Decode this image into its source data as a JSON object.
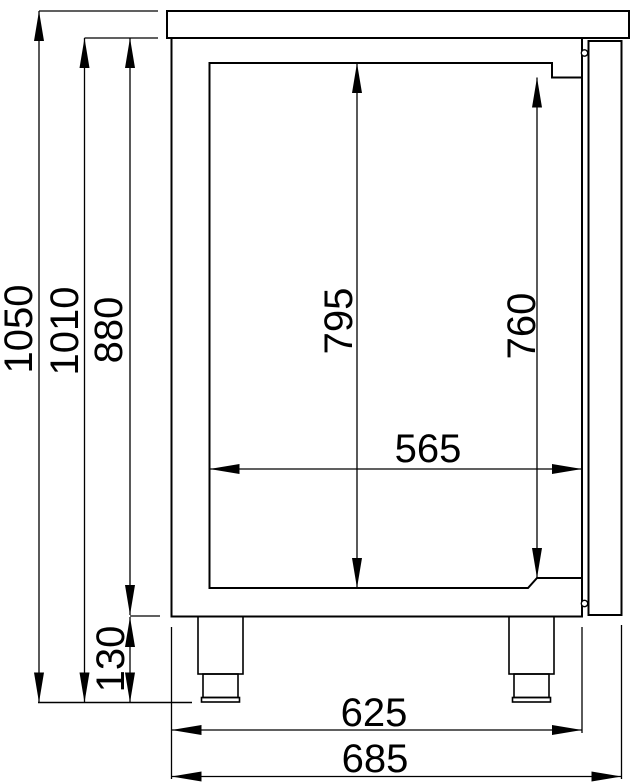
{
  "drawing": {
    "description": "side view technical drawing of refrigerated counter with dimension lines",
    "colors": {
      "line": "#000000",
      "background": "#ffffff"
    }
  },
  "dimensions": {
    "overall_height": "1050",
    "height_under_worktop": "1010",
    "body_height": "880",
    "interior_height_back": "795",
    "interior_height_front": "760",
    "interior_depth": "565",
    "leg_height": "130",
    "body_depth": "625",
    "overall_depth": "685"
  }
}
